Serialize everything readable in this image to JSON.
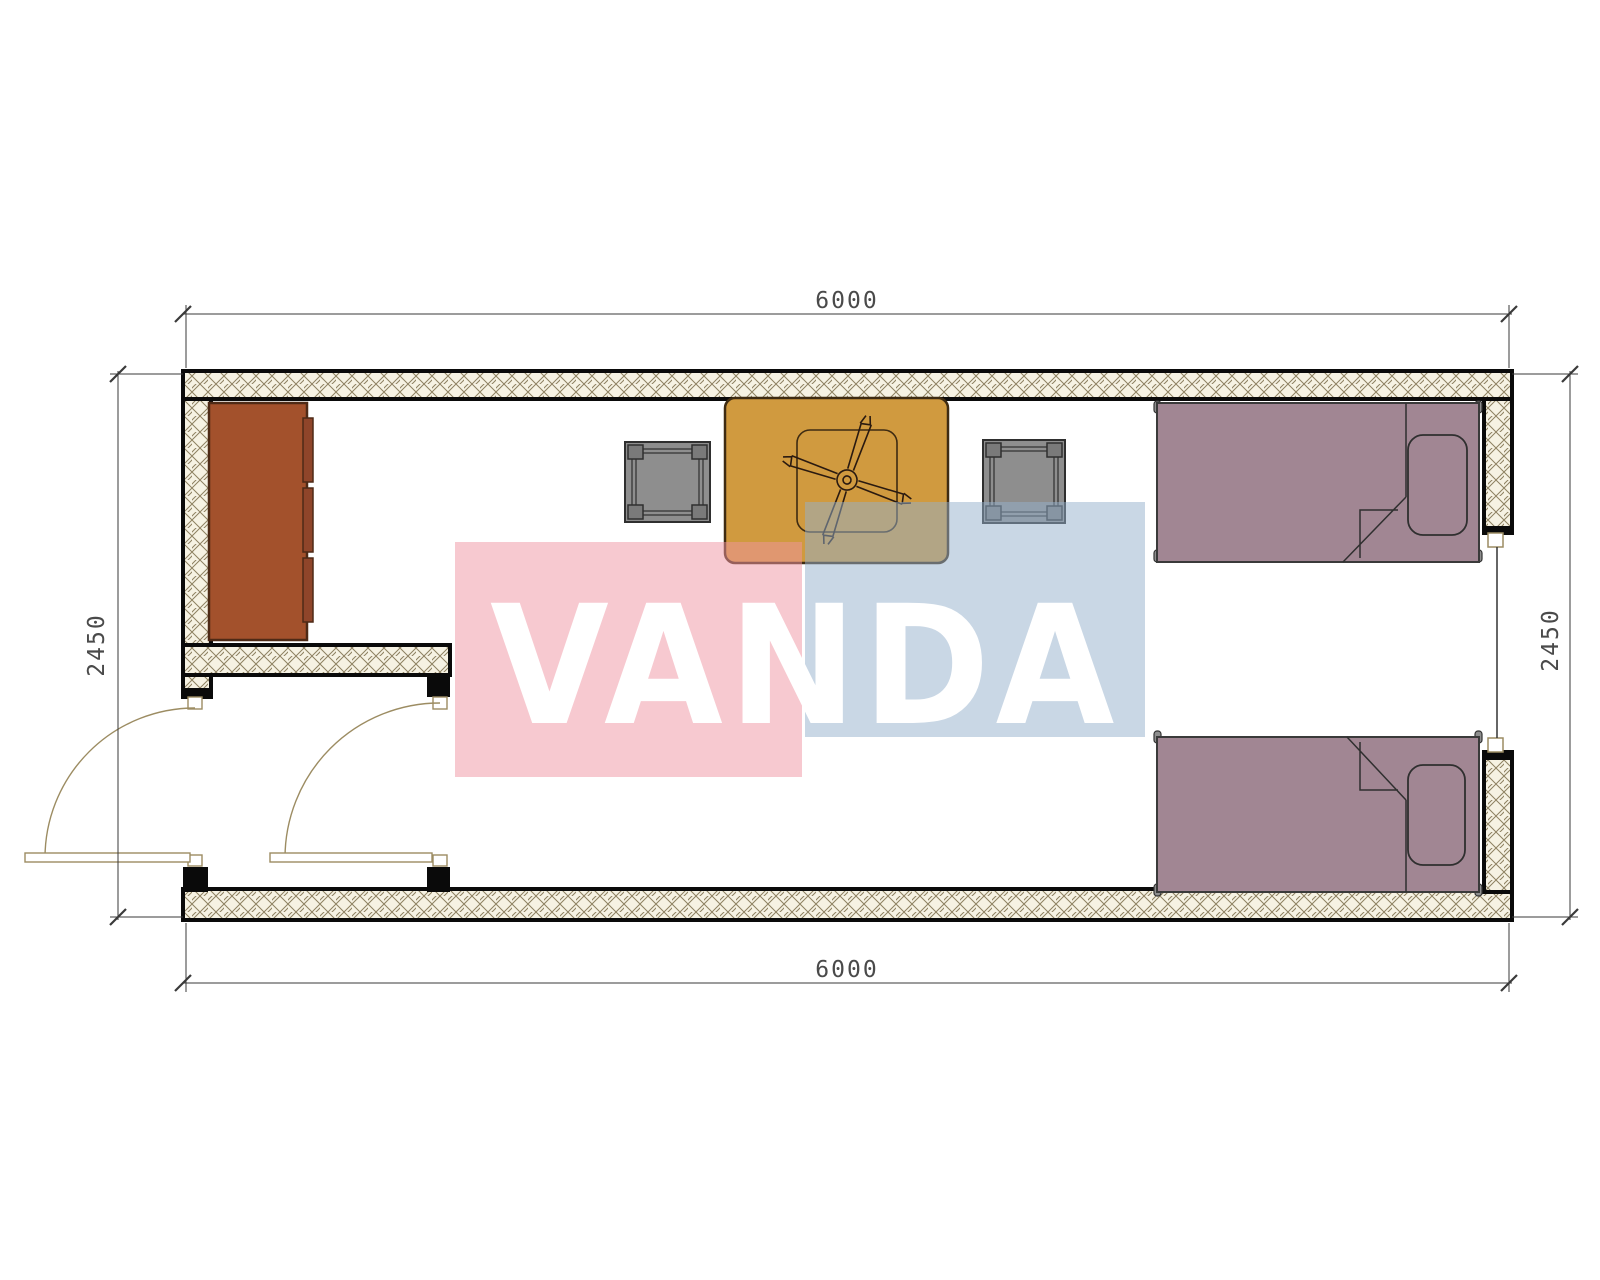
{
  "drawing": {
    "type": "floor-plan",
    "subject": "container house twin-bed room plan",
    "dimensions": {
      "top": "6000",
      "bottom": "6000",
      "left": "2450",
      "right": "2450"
    },
    "furniture": {
      "wardrobe": "wardrobe",
      "table": "table with ceiling fan symbol",
      "stools": 2,
      "beds": 2,
      "doors": 2,
      "window": 1
    }
  },
  "watermark": {
    "text": "VANDA",
    "pink_block_color": "#F7CBD2",
    "blue_block_color": "#CBD7E5",
    "text_color": "#FFFFFF"
  },
  "colors": {
    "wall_outline": "#0a0a0a",
    "wall_hatch_background": "#F6F2E3",
    "wall_hatch_line": "#8D8060",
    "wardrobe_fill": "#A3512C",
    "wardrobe_doors": "#8F452A",
    "table_fill": "#D09A3F",
    "stool_fill": "#8E8E8E",
    "bed_fill": "#A18693",
    "door_swing_line": "#9C8C62",
    "dimension_line": "#3a3a3a"
  }
}
